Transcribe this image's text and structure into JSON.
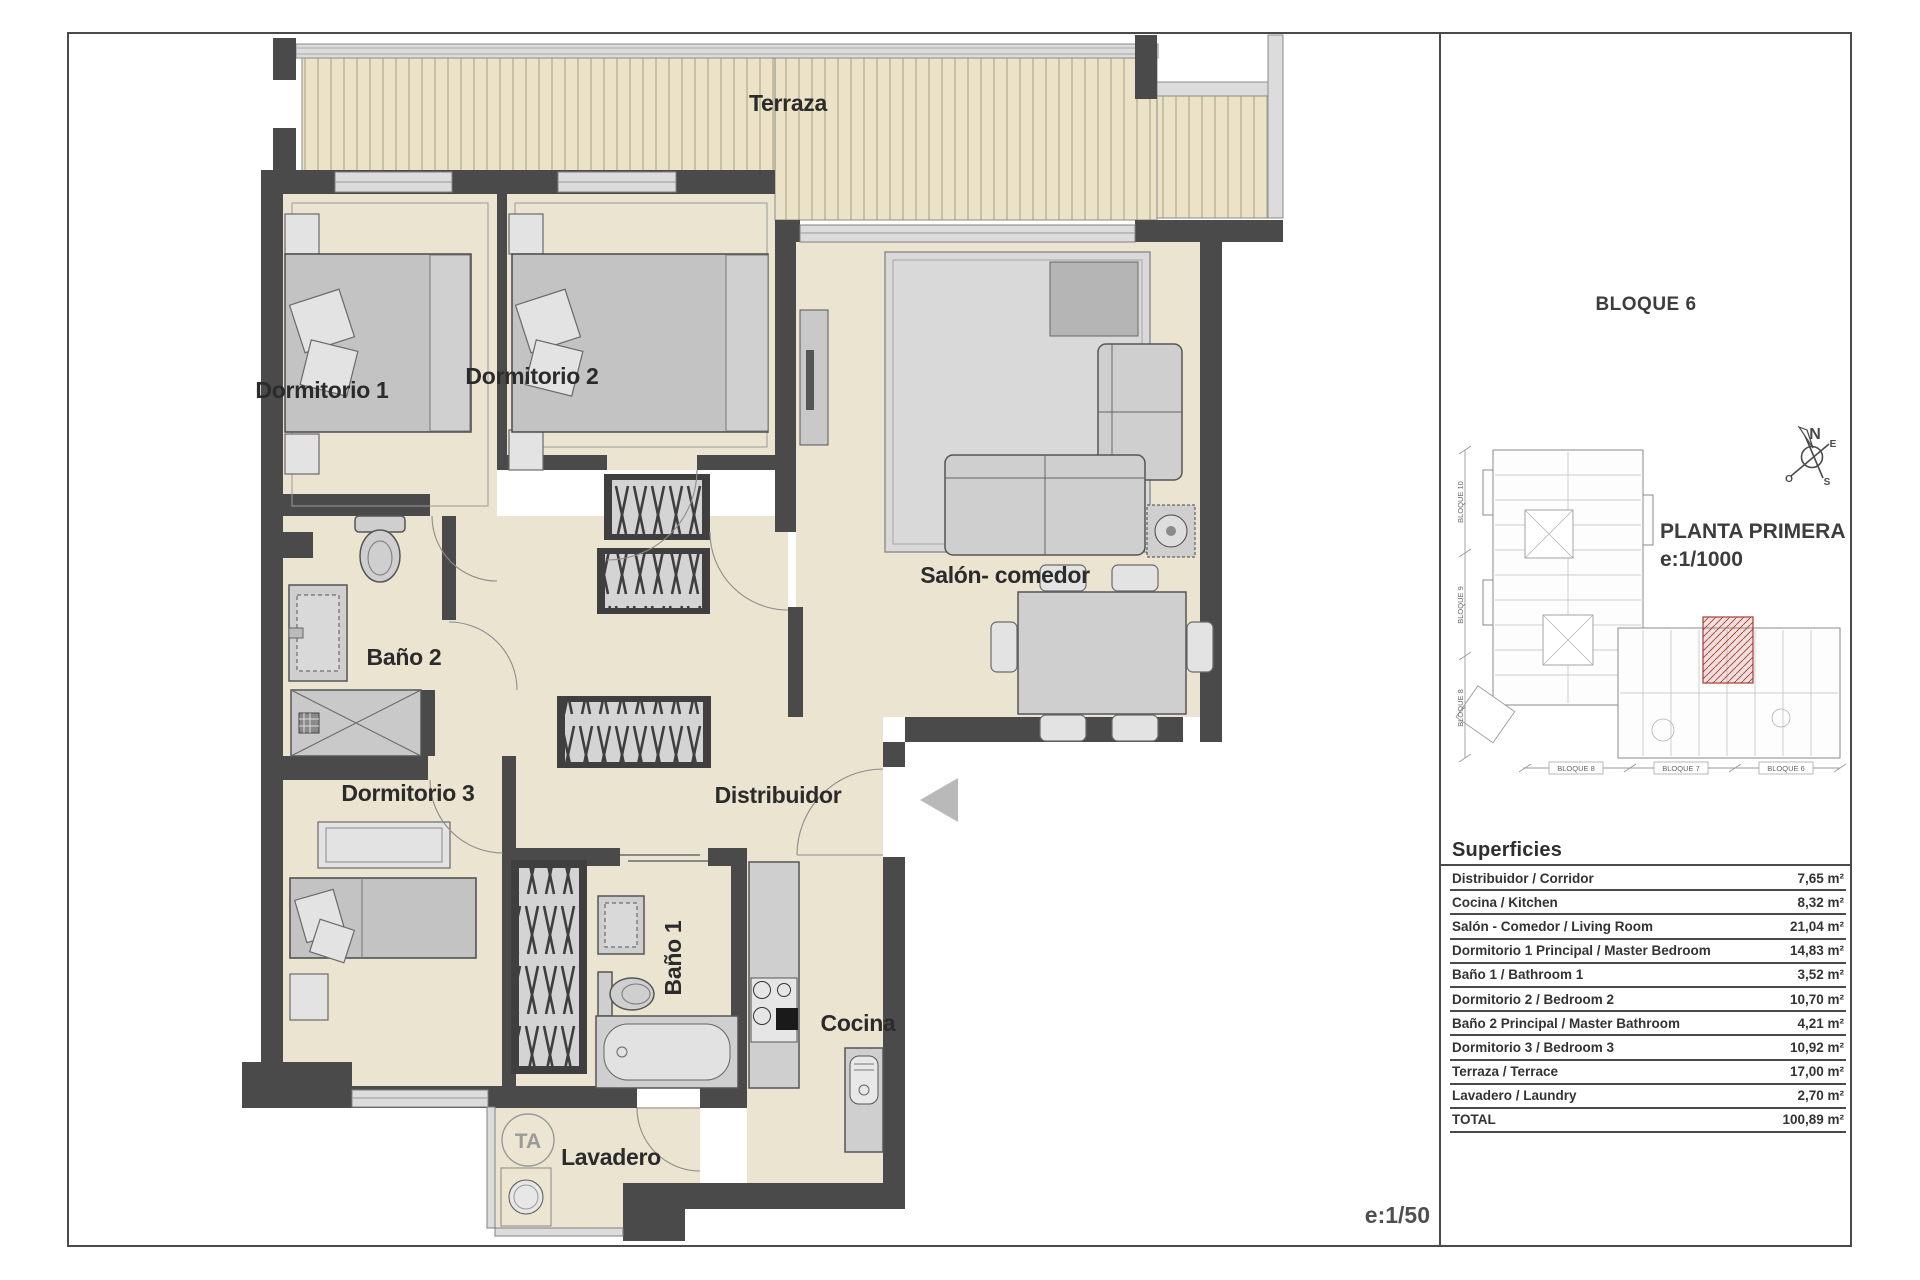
{
  "plan": {
    "labels": {
      "terraza": "Terraza",
      "dormitorio1": "Dormitorio 1",
      "dormitorio2": "Dormitorio 2",
      "salon": "Salón- comedor",
      "bano2": "Baño 2",
      "dormitorio3": "Dormitorio 3",
      "distribuidor": "Distribuidor",
      "bano1": "Baño 1",
      "cocina": "Cocina",
      "lavadero": "Lavadero",
      "ta": "TA"
    },
    "scale_note": "e:1/50"
  },
  "panel": {
    "block_title": "BLOQUE 6",
    "floor_title": "PLANTA PRIMERA",
    "floor_scale": "e:1/1000",
    "compass": {
      "n": "N",
      "e": "E",
      "s": "S",
      "w": "O"
    },
    "site_map": {
      "left_labels": [
        "BLOQUE 10",
        "BLOQUE 9",
        "BLOQUE 8"
      ],
      "bottom_labels": [
        "BLOQUE 8",
        "BLOQUE 7",
        "BLOQUE 6"
      ]
    },
    "superficies": {
      "title": "Superficies",
      "rows": [
        {
          "label": "Distribuidor / Corridor",
          "value": "7,65 m²"
        },
        {
          "label": "Cocina / Kitchen",
          "value": "8,32 m²"
        },
        {
          "label": "Salón - Comedor / Living Room",
          "value": "21,04 m²"
        },
        {
          "label": "Dormitorio 1 Principal / Master Bedroom",
          "value": "14,83 m²"
        },
        {
          "label": "Baño 1 / Bathroom 1",
          "value": "3,52 m²"
        },
        {
          "label": "Dormitorio 2 / Bedroom 2",
          "value": "10,70 m²"
        },
        {
          "label": "Baño 2 Principal / Master Bathroom",
          "value": "4,21 m²"
        },
        {
          "label": "Dormitorio 3 / Bedroom 3",
          "value": "10,92 m²"
        },
        {
          "label": "Terraza / Terrace",
          "value": "17,00 m²"
        },
        {
          "label": "Lavadero / Laundry",
          "value": "2,70 m²"
        },
        {
          "label": "TOTAL",
          "value": "100,89 m²"
        }
      ]
    }
  },
  "colors": {
    "wall": "#4a4a4a",
    "floor": "#ebe4d0",
    "terrace_floor": "#ebe2c7",
    "highlight": "#b23b32"
  }
}
